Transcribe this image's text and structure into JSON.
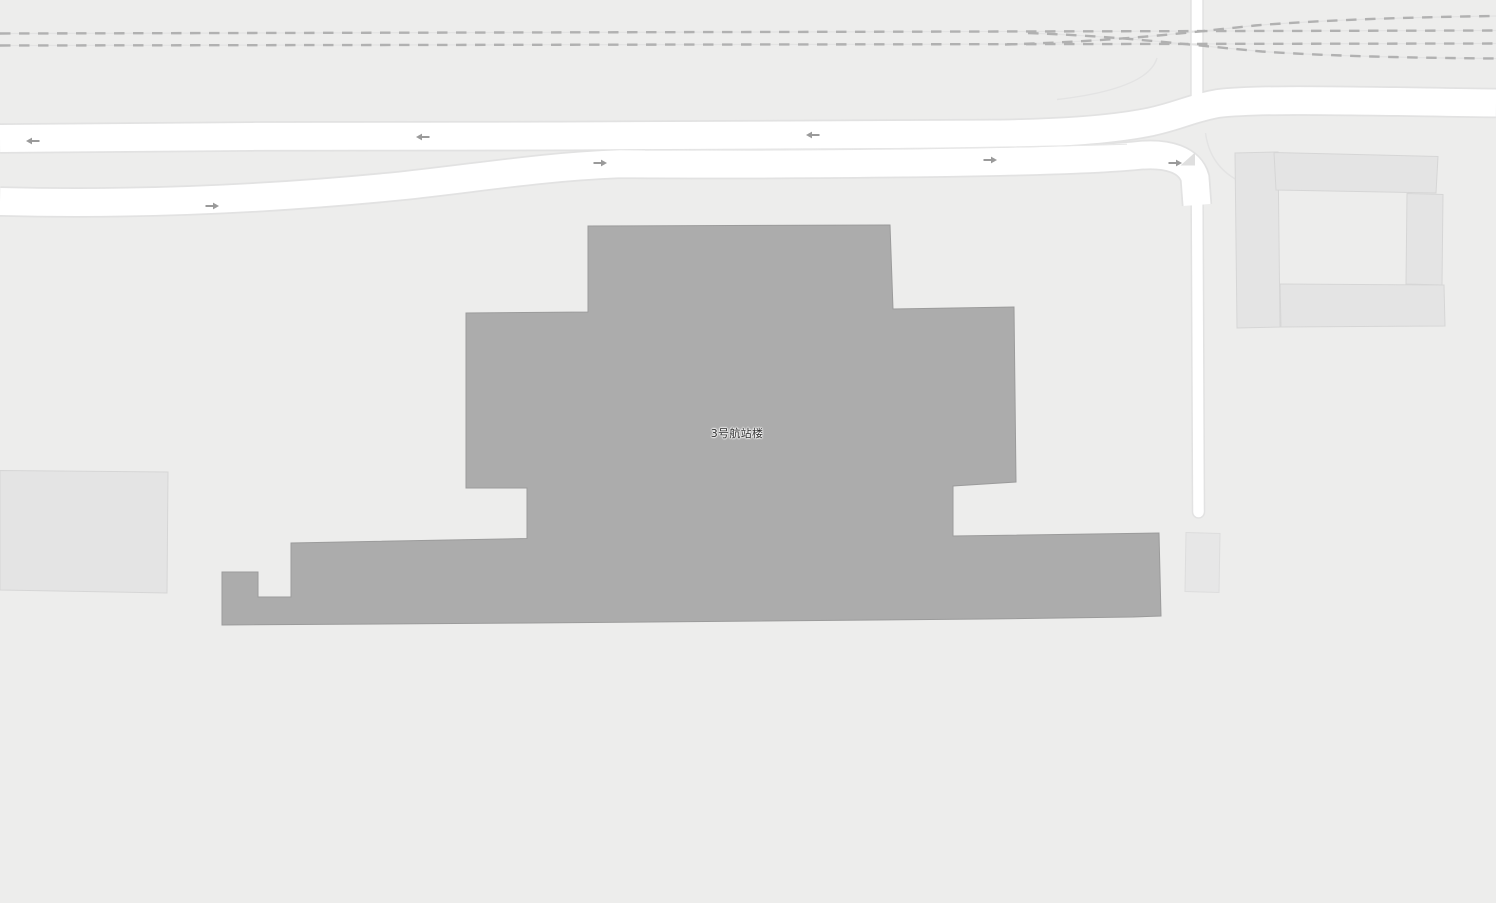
{
  "map": {
    "terminal_label": "3号航站楼",
    "colors": {
      "background": "#ededec",
      "terminal_fill": "#acacac",
      "terminal_stroke": "#9b9b9b",
      "building_fill": "#e4e4e4",
      "building_stroke": "#d6d6d6",
      "building2_fill": "#e7e7e7",
      "building2_stroke": "#dddddd",
      "road_fill": "#ffffff",
      "road_casing": "#e2e2e2",
      "road_divider": "#e7e7e7",
      "railway_dash": "#b1b1b1",
      "railway_underline": "#e3e3e3",
      "apron_line": "#e3e3e3",
      "island_fill": "#dfdfdf",
      "arrow": "#9a9a9a",
      "label_color": "#2e2e2e"
    },
    "arrows": [
      {
        "x": 33,
        "y": 141,
        "dir": "left"
      },
      {
        "x": 423,
        "y": 137,
        "dir": "left"
      },
      {
        "x": 813,
        "y": 135,
        "dir": "left"
      },
      {
        "x": 212,
        "y": 206,
        "dir": "right"
      },
      {
        "x": 600,
        "y": 163,
        "dir": "right"
      },
      {
        "x": 990,
        "y": 160,
        "dir": "right"
      },
      {
        "x": 1175,
        "y": 163,
        "dir": "right"
      }
    ]
  }
}
